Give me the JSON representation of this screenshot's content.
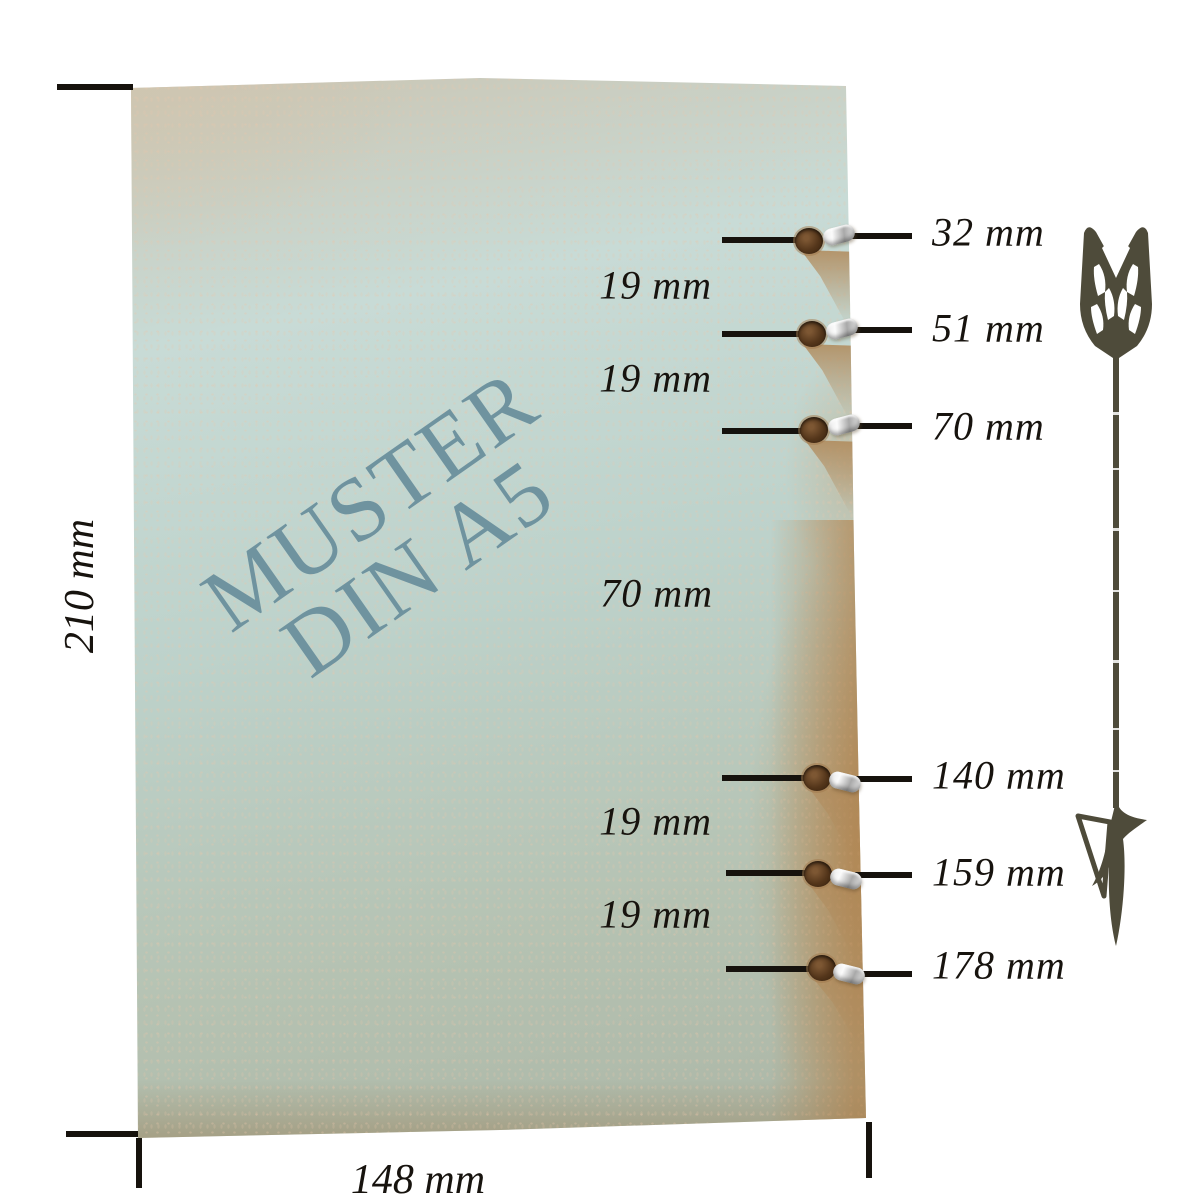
{
  "diagram": {
    "watermark": {
      "line1": "MUSTER",
      "line2": "DIN A5"
    },
    "sheet": {
      "height": "210 mm",
      "width": "148 mm"
    },
    "hole_labels": [
      "32 mm",
      "51 mm",
      "70 mm",
      "140 mm",
      "159 mm",
      "178 mm"
    ],
    "gap_labels": [
      "19 mm",
      "19 mm",
      "70 mm",
      "19 mm",
      "19 mm"
    ],
    "icons": {
      "direction_arrow": "down-arrow-icon"
    },
    "colors": {
      "background": "#ffffff",
      "paper_blue": "#c6dad4",
      "paper_beige": "#ccc4b1",
      "paper_sage": "#adb6a6",
      "paper_rust": "#b47e42",
      "watermark": "#6f939f",
      "dimension_lines": "#16120d",
      "arrow": "#4e4b3a",
      "hole_brown": "#53351a",
      "eyelet_silver": "#c9c9c9"
    }
  }
}
